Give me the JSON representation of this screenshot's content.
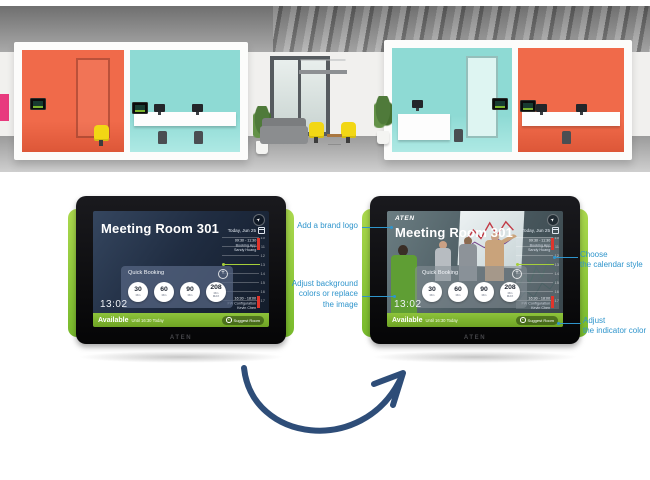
{
  "colors": {
    "annotation_blue": "#2f95cc",
    "arrow_navy": "#2e4d78",
    "device_green": "#8dc63f",
    "status_green": "#7db32c",
    "event_red": "#e0352c",
    "now_green": "#a6cf3a",
    "screen_navy": "#1f2c41"
  },
  "photo": {
    "description": "Open-plan office with orange and teal meeting pods, booking panels mounted beside each room"
  },
  "device": {
    "bezel_logo": "ATEN"
  },
  "icons": {
    "share": "➤",
    "suggest": "+"
  },
  "screen": {
    "brand_logo": "ATEN",
    "title": "Meeting Room 301",
    "date_label": "Today, Jun 25",
    "clock": "13:02",
    "calendar": {
      "hours": [
        "10",
        "11",
        "12",
        "13",
        "14",
        "15",
        "16",
        "17"
      ],
      "events": [
        {
          "time": "09:30 - 11:30",
          "title": "Booking App",
          "owner": "Sandy Huang"
        },
        {
          "time": "16:30 - 18:00",
          "title": "FW Configuration",
          "owner": "Kevin Chen"
        }
      ]
    },
    "quick_booking": {
      "title": "Quick Booking",
      "add_button": "+",
      "options": [
        {
          "value": "30",
          "unit": "Min"
        },
        {
          "value": "60",
          "unit": "Min"
        },
        {
          "value": "90",
          "unit": "Min"
        },
        {
          "value": "208",
          "unit": "Min\nMAX"
        }
      ]
    },
    "status": {
      "label": "Available",
      "detail": "Until 16:30 Today",
      "suggest_button": "Suggest Room"
    }
  },
  "annotations": {
    "add_brand_logo": "Add a brand logo",
    "adjust_background": "Adjust background\ncolors or replace\nthe image",
    "choose_calendar": "Choose\nthe calendar style",
    "adjust_indicator": "Adjust\nthe indicator color"
  }
}
